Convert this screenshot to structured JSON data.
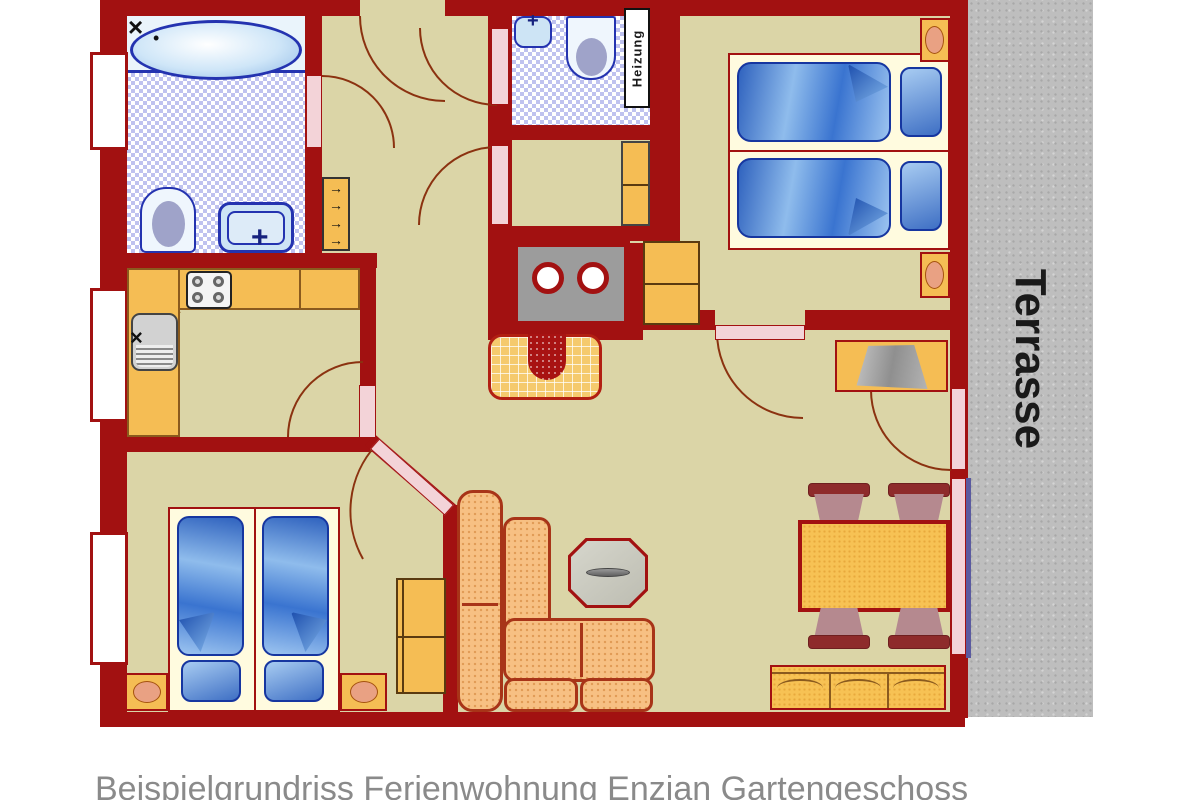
{
  "caption": "Beispielgrundriss Ferienwohnung Enzian Gartengeschoss",
  "labels": {
    "terrasse": "Terrasse",
    "heizung": "Heizung"
  },
  "icons": {
    "coat_hook_arrow": "→",
    "faucet_cross": "×",
    "drip_dot": "•",
    "sink_cross": "+"
  },
  "colors": {
    "wall": "#A21111",
    "floor_tan": "#DBD5A7",
    "tile_blue": "#BFC2EF",
    "furniture_orange": "#F5BD54",
    "door_pink": "#F3D3D8",
    "bed_blue": "#3A74D0",
    "sofa_peach": "#F7C083",
    "chair_mauve": "#B5898F",
    "terrace_gray": "#BEBEBE",
    "swing_arc_brown": "#8B3210"
  }
}
